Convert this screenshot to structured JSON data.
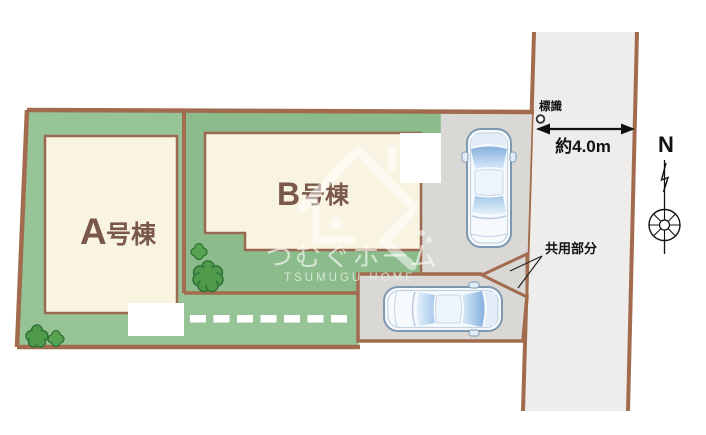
{
  "plan": {
    "plots": [
      {
        "name": "A",
        "suffix": "号棟"
      },
      {
        "name": "B",
        "suffix": "号棟"
      }
    ],
    "road": {
      "sign_label": "標識",
      "width_label": "約4.0m"
    },
    "common_area_label": "共用部分",
    "compass": {
      "north_label": "N"
    },
    "watermark": {
      "brand_jp": "つむぐホーム",
      "brand_en": "TSUMUGU HOME"
    },
    "colors": {
      "site_green": "#97c497",
      "plot_b_green": "#8cbb8c",
      "boundary_brown": "#a26b4e",
      "building_fill": "#f9f4e2",
      "building_outline": "#9b6952",
      "building_label_brown": "#7a584a",
      "parking_grey": "#d9d8d5",
      "road_grey": "#eeedeb",
      "tree_green": "#4f9b4b",
      "car_glass_blue": "#86b1dd",
      "annotation_black": "#111111",
      "dash_white": "#ffffff"
    }
  }
}
